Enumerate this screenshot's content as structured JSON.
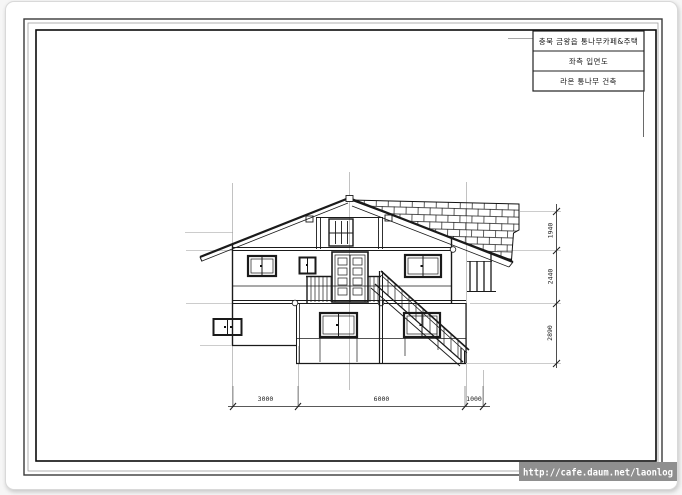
{
  "title_block": {
    "rows": [
      "충북 금왕읍 통나무카페&주택",
      "좌측 입면도",
      "라온 통나무 건축"
    ]
  },
  "dimensions": {
    "bottom": [
      "3000",
      "6000",
      "1000"
    ],
    "right": [
      "1940",
      "2440",
      "2890"
    ]
  },
  "watermark": {
    "url": "http://cafe.daum.net/laonlog"
  },
  "colors": {
    "line": "#1a1a1a",
    "guide": "#999999",
    "paper": "#ffffff",
    "watermark_bg": "#8f8f8f",
    "watermark_text": "#ffffff"
  }
}
